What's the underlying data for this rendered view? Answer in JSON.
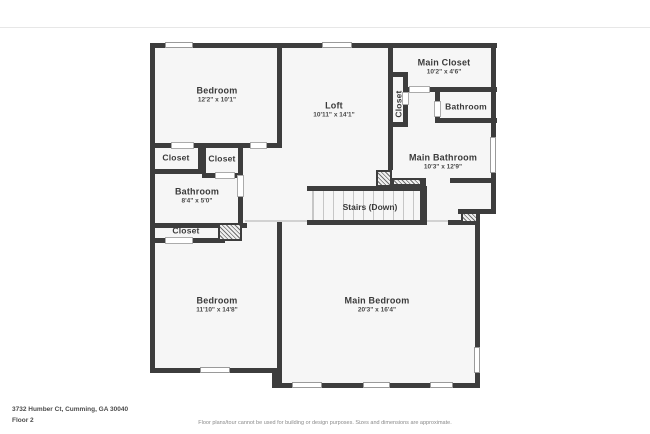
{
  "meta": {
    "address": "3732 Humber Ct, Cumming, GA 30040",
    "floor_label": "Floor 2",
    "disclaimer": "Floor plans/tour cannot be used for building or design purposes. Sizes and dimensions are approximate."
  },
  "colors": {
    "wall": "#3d3d3d",
    "floor_fill": "#f6f6f6",
    "text": "#3a3a3a"
  },
  "rooms": {
    "bedroom1": {
      "name": "Bedroom",
      "dims": "12'2\" x 10'1\""
    },
    "loft": {
      "name": "Loft",
      "dims": "10'11\" x 14'1\""
    },
    "main_closet": {
      "name": "Main Closet",
      "dims": "10'2\" x 4'6\""
    },
    "closet_vert": {
      "name": "Closet"
    },
    "bathroom_top": {
      "name": "Bathroom"
    },
    "main_bathroom": {
      "name": "Main Bathroom",
      "dims": "10'3\" x 12'9\""
    },
    "closet_a": {
      "name": "Closet"
    },
    "closet_b": {
      "name": "Closet"
    },
    "bathroom_mid": {
      "name": "Bathroom",
      "dims": "8'4\" x 5'0\""
    },
    "closet_c": {
      "name": "Closet"
    },
    "stairs": {
      "name": "Stairs (Down)"
    },
    "bedroom2": {
      "name": "Bedroom",
      "dims": "11'10\" x 14'8\""
    },
    "main_bedroom": {
      "name": "Main Bedroom",
      "dims": "20'3\" x 16'4\""
    }
  }
}
